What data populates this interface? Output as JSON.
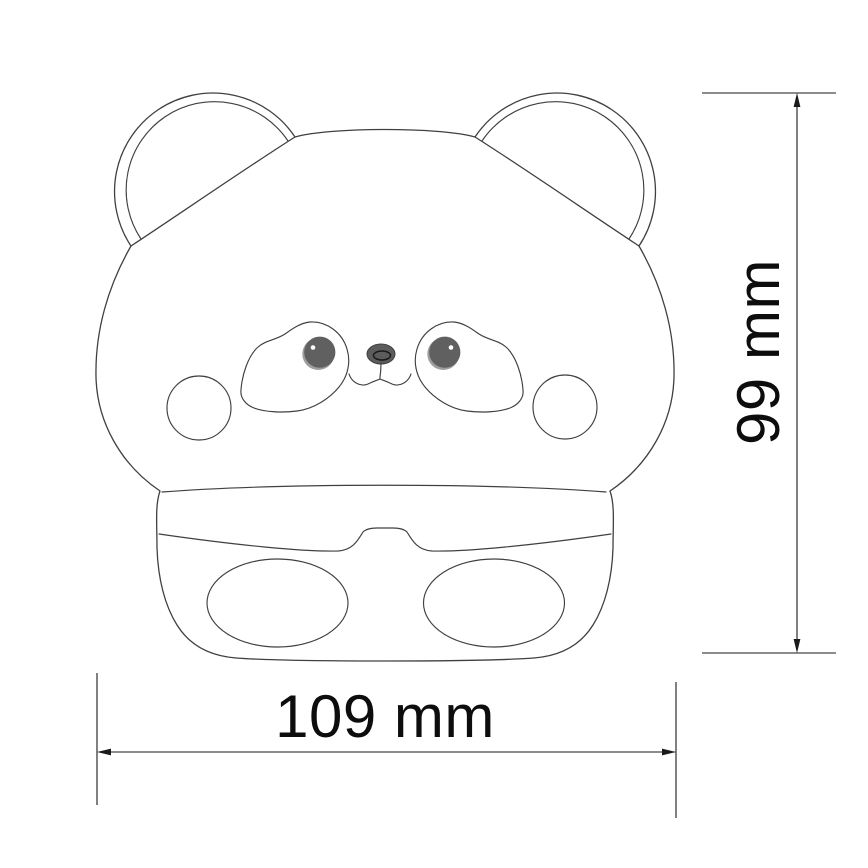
{
  "dimensions": {
    "height": {
      "label": "99 mm"
    },
    "width": {
      "label": "109 mm"
    }
  },
  "colors": {
    "background": "#ffffff",
    "line": "#404040",
    "dim": "#1a1a1a",
    "text": "#0d0d0d",
    "eye_fill": "#606060",
    "eye_ring": "#9e9e9e",
    "eye_highlight": "#ffffff",
    "nose_fill": "#5c5c5c"
  }
}
